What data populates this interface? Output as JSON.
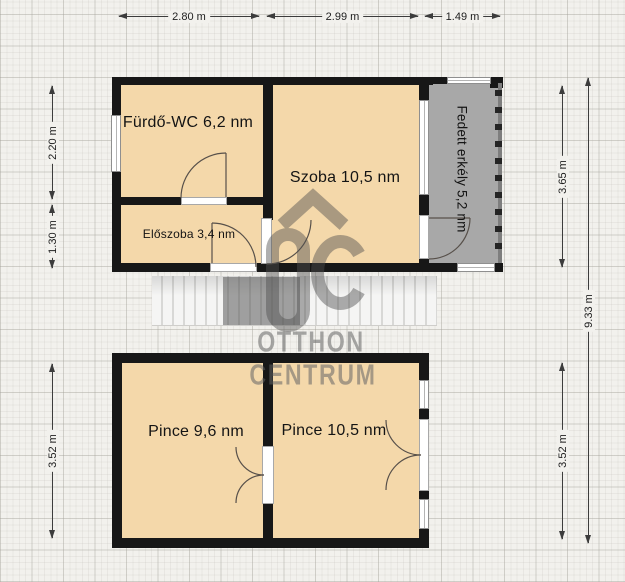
{
  "rooms": {
    "furdo": "Fürdő-WC 6,2 nm",
    "szoba": "Szoba 10,5 nm",
    "eloszoba": "Előszoba 3,4 nm",
    "erkely": "Fedett erkély 5,2 nm",
    "pince_left": "Pince 9,6 nm",
    "pince_right": "Pince 10,5 nm"
  },
  "dimensions": {
    "top_1": "2.80 m",
    "top_2": "2.99 m",
    "top_3": "1.49 m",
    "left_upper_1": "2.20 m",
    "left_upper_2": "1.30 m",
    "left_lower": "3.52 m",
    "right_upper": "3.65 m",
    "right_lower": "3.52 m",
    "right_total": "9.33 m"
  },
  "watermark": {
    "brand_top": "OTTHON",
    "brand_bottom": "CENTRUM"
  },
  "colors": {
    "background": "#f2f1ed",
    "room_fill": "#f4d8aa",
    "balcony_fill": "#a8a8a8",
    "wall": "#171717",
    "dimension_line": "#3c3c3c",
    "watermark_gray": "#8a8a8a",
    "stairs_tread": "#f5f5f4"
  }
}
